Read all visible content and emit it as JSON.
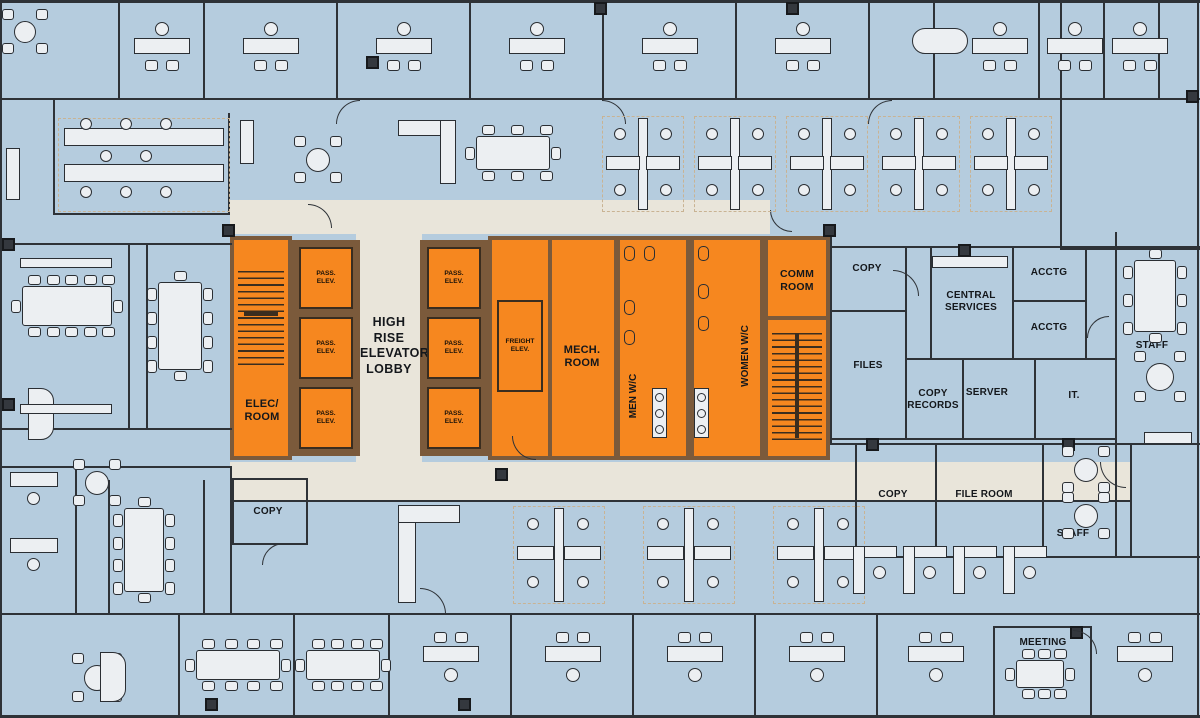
{
  "palette": {
    "floor_blue": "#b5ccde",
    "core_orange": "#f6871f",
    "core_wall_brown": "#7b5a3b",
    "lobby_beige": "#e9e5da",
    "wall_dark": "#2e3237",
    "furniture_light": "#eceff2",
    "cubicle_dash_tan": "#c9b393"
  },
  "core": {
    "high_rise_lobby": "HIGH RISE ELEVATOR LOBBY",
    "pass_elev": "PASS. ELEV.",
    "freight_elev": "FREIGHT ELEV.",
    "mech_room": "MECH. ROOM",
    "men_wc": "MEN W/C",
    "women_wc": "WOMEN W/C",
    "comm_room": "COMM ROOM",
    "elec_room": "ELEC/ ROOM"
  },
  "service_rooms": {
    "copy": "COPY",
    "central_services": "CENTRAL SERVICES",
    "acctg": "ACCTG",
    "files": "FILES",
    "copy_records": "COPY RECORDS",
    "server": "SERVER",
    "it": "IT.",
    "staff": "STAFF",
    "file_room": "FILE ROOM"
  },
  "other_rooms": {
    "meeting": "MEETING"
  }
}
